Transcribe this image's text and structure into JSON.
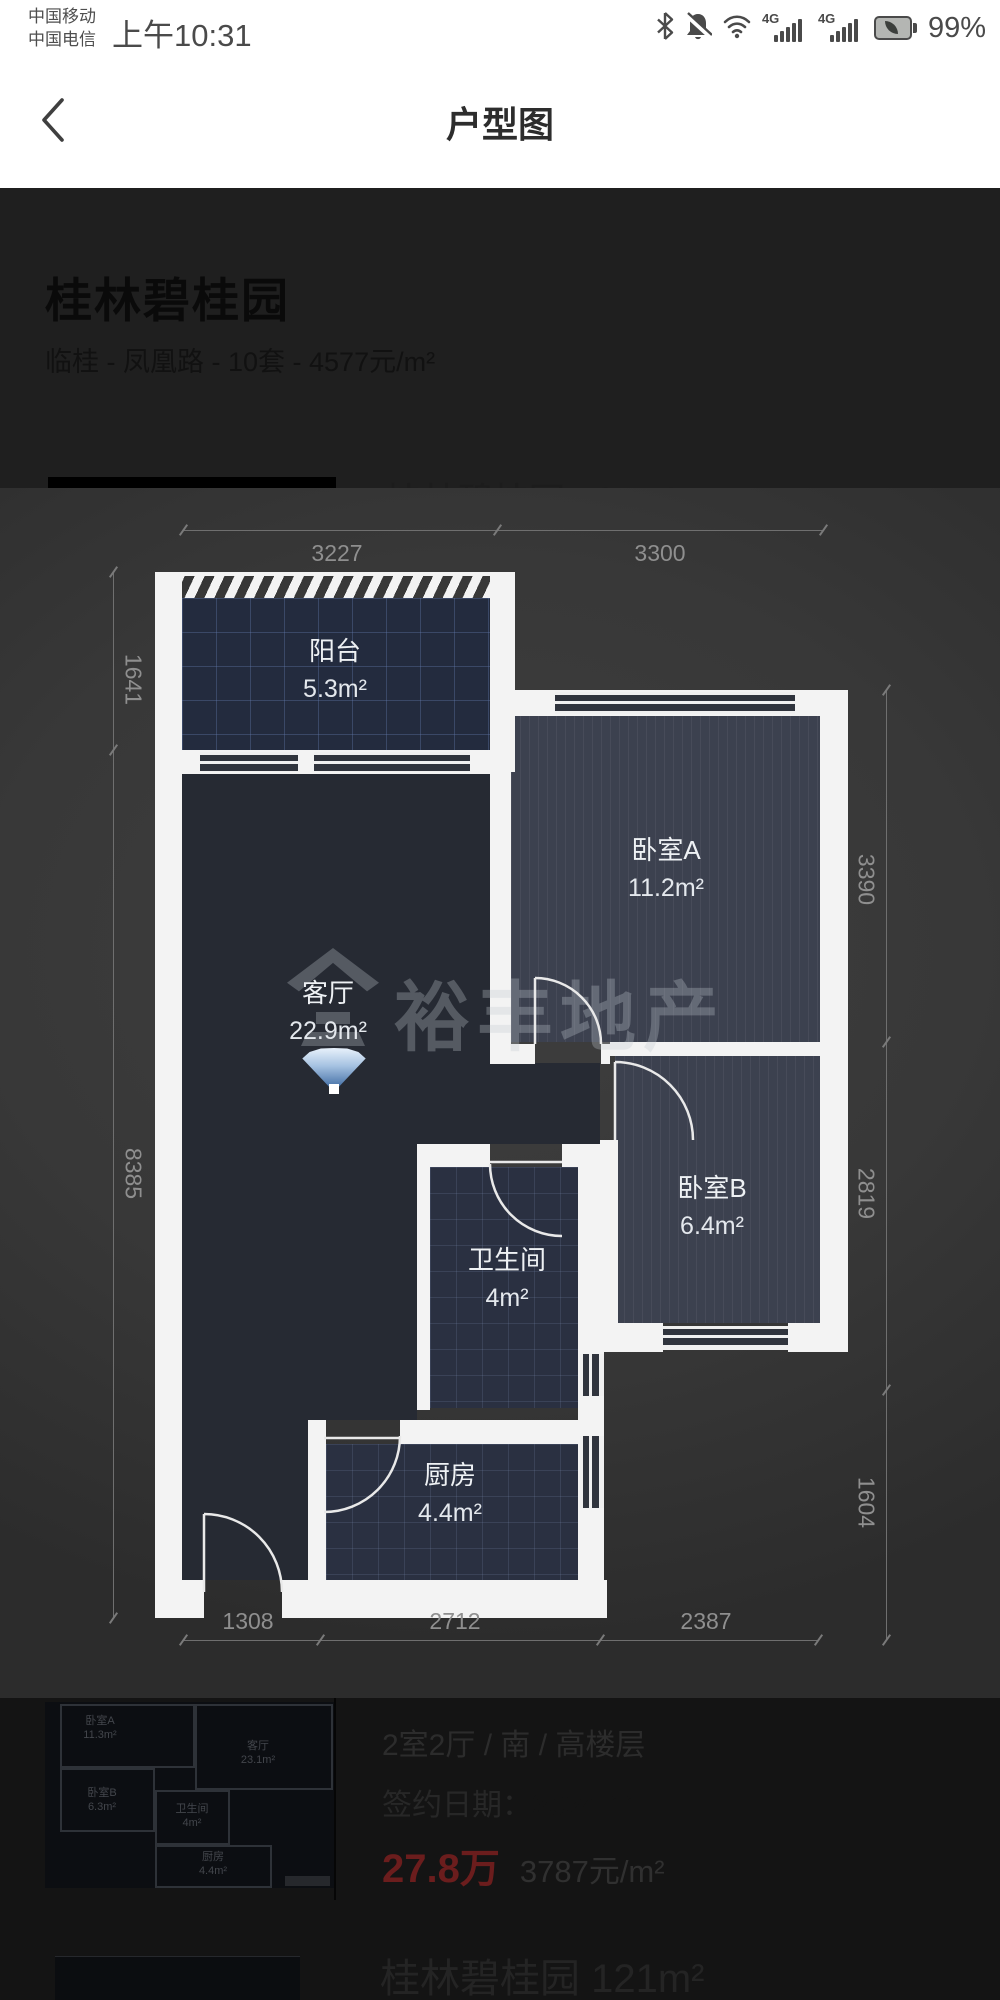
{
  "status_bar": {
    "carrier_line1": "中国移动",
    "carrier_line2": "中国电信",
    "time": "上午10:31",
    "network_badge_1": "4G",
    "network_badge_2": "4G",
    "battery_percent": "99%"
  },
  "nav": {
    "title": "户型图"
  },
  "header": {
    "community_name": "桂林碧桂园",
    "summary": "临桂 - 凤凰路 - 10套 - 4577元/m²"
  },
  "clipped_row": {
    "title": "桂林碧桂园 121m²"
  },
  "floor_plan": {
    "watermark_text": "裕丰地产",
    "rooms": [
      {
        "name": "阳台",
        "area": "5.3m²"
      },
      {
        "name": "卧室A",
        "area": "11.2m²"
      },
      {
        "name": "客厅",
        "area": "22.9m²"
      },
      {
        "name": "卧室B",
        "area": "6.4m²"
      },
      {
        "name": "卫生间",
        "area": "4m²"
      },
      {
        "name": "厨房",
        "area": "4.4m²"
      }
    ],
    "dimensions": {
      "top": [
        "3227",
        "3300"
      ],
      "bottom": [
        "1308",
        "2712",
        "2387"
      ],
      "left": [
        "1641",
        "8385"
      ],
      "right": [
        "3390",
        "2819",
        "1604"
      ]
    }
  },
  "listing_row": {
    "specs": "2室2厅 / 南 / 高楼层",
    "sign_label": "签约日期：",
    "sign_value": "2024-11",
    "price": "27.8万",
    "unit_price": "3787元/m²",
    "thumbnail_rooms": [
      {
        "name": "卧室A",
        "area": "11.3m²"
      },
      {
        "name": "客厅",
        "area": "23.1m²"
      },
      {
        "name": "卧室B",
        "area": "6.3m²"
      },
      {
        "name": "卫生间",
        "area": "4m²"
      },
      {
        "name": "厨房",
        "area": "4.4m²"
      }
    ]
  },
  "next_listing": {
    "title": "桂林碧桂园 121m²"
  },
  "colors": {
    "wall_white": "#f3f3f3",
    "plan_background": "#383838",
    "room_dark": "#262a33",
    "room_bedroom": "#3c414f",
    "price_red": "#6b1d1d",
    "fan_blue": "#2e5d99",
    "dim_label_gray": "#8f8f8f"
  }
}
